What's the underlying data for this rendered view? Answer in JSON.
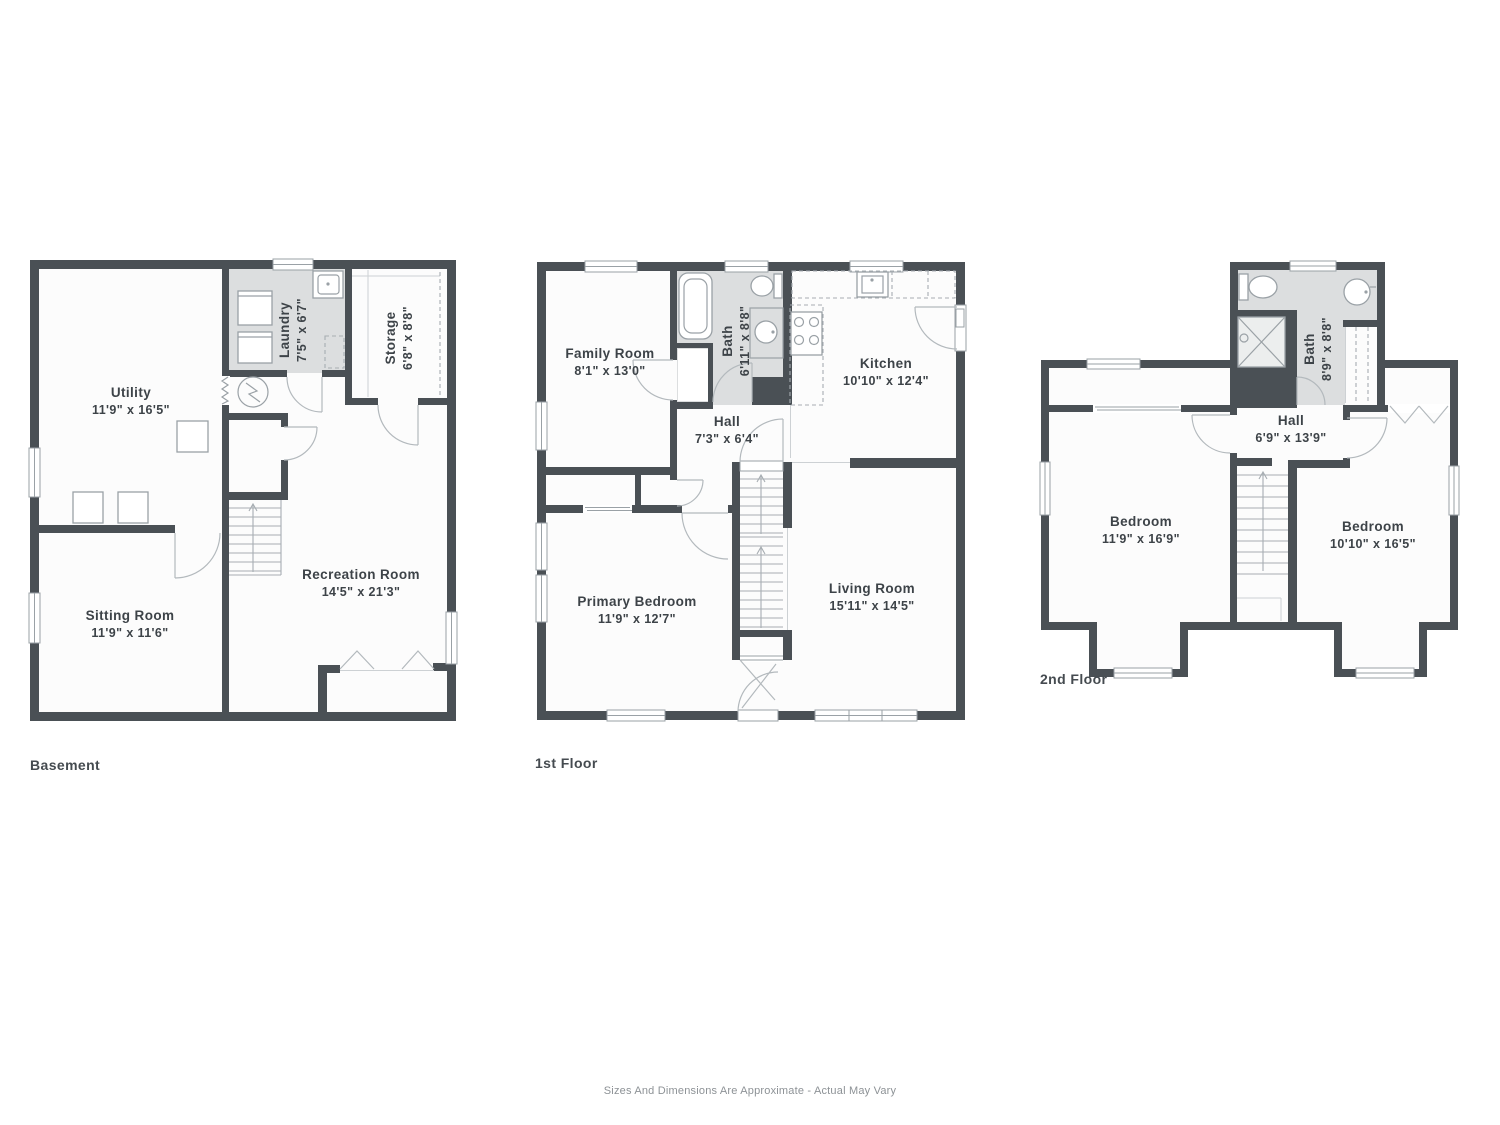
{
  "footer": {
    "disclaimer": "Sizes And Dimensions Are Approximate - Actual May Vary"
  },
  "colors": {
    "wall": "#4a5055",
    "floor": "#fcfcfc",
    "wet_room_floor": "#dcdedf",
    "label_text": "#3d4348",
    "footer_text": "#8d9296"
  },
  "floors": [
    {
      "title": "Basement",
      "rooms": [
        {
          "name": "Utility",
          "dims": "11'9\" x 16'5\""
        },
        {
          "name": "Laundry",
          "dims": "7'5\" x 6'7\""
        },
        {
          "name": "Storage",
          "dims": "6'8\" x 8'8\""
        },
        {
          "name": "Sitting Room",
          "dims": "11'9\" x 11'6\""
        },
        {
          "name": "Recreation Room",
          "dims": "14'5\" x 21'3\""
        }
      ]
    },
    {
      "title": "1st Floor",
      "rooms": [
        {
          "name": "Family Room",
          "dims": "8'1\" x 13'0\""
        },
        {
          "name": "Bath",
          "dims": "6'11\" x 8'8\""
        },
        {
          "name": "Kitchen",
          "dims": "10'10\" x 12'4\""
        },
        {
          "name": "Hall",
          "dims": "7'3\" x 6'4\""
        },
        {
          "name": "Primary Bedroom",
          "dims": "11'9\" x 12'7\""
        },
        {
          "name": "Living Room",
          "dims": "15'11\" x 14'5\""
        }
      ]
    },
    {
      "title": "2nd Floor",
      "rooms": [
        {
          "name": "Bath",
          "dims": "8'9\" x 8'8\""
        },
        {
          "name": "Hall",
          "dims": "6'9\" x 13'9\""
        },
        {
          "name": "Bedroom",
          "dims": "11'9\" x 16'9\""
        },
        {
          "name": "Bedroom",
          "dims": "10'10\" x 16'5\""
        }
      ]
    }
  ]
}
